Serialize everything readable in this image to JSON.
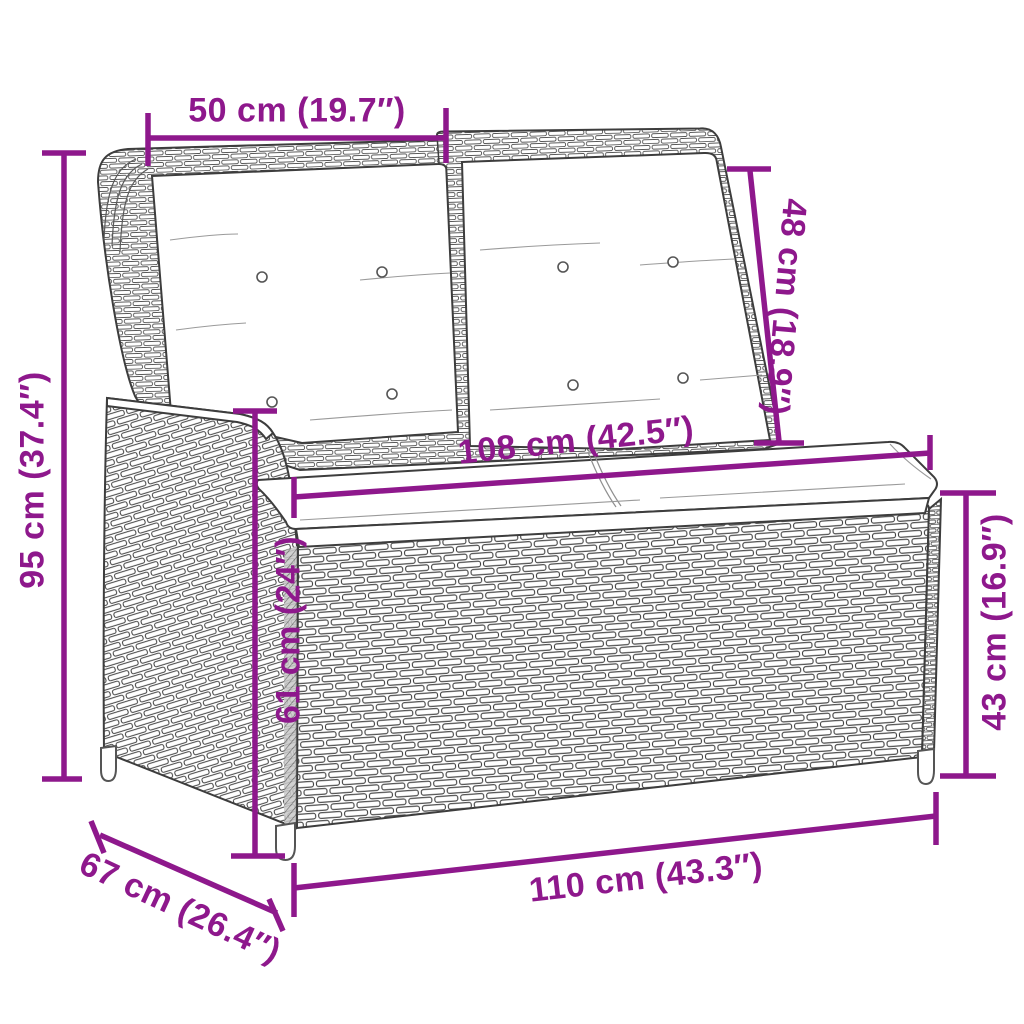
{
  "figure": {
    "type": "product-dimension-diagram",
    "subject": "poly rattan reclining garden bench with white cushions",
    "background": "#ffffff"
  },
  "colors": {
    "dimension_accent": "#8e188c",
    "line_art": "#3d3d3d",
    "cushion": "#ffffff"
  },
  "dimensions": {
    "backrest_width": {
      "cm": 50,
      "inch": "19.7",
      "label": "50 cm (19.7″)"
    },
    "backrest_height": {
      "cm": 48,
      "inch": "18.9",
      "label": "48 cm (18.9″)"
    },
    "total_height": {
      "cm": 95,
      "inch": "37.4",
      "label": "95 cm (37.4″)"
    },
    "seat_width": {
      "cm": 108,
      "inch": "42.5",
      "label": "108 cm (42.5″)"
    },
    "seat_front_height": {
      "cm": 61,
      "inch": "24",
      "label": "61 cm (24″)"
    },
    "side_height": {
      "cm": 43,
      "inch": "16.9",
      "label": "43 cm (16.9″)"
    },
    "depth": {
      "cm": 67,
      "inch": "26.4",
      "label": "67 cm (26.4″)"
    },
    "total_width": {
      "cm": 110,
      "inch": "43.3",
      "label": "110 cm (43.3″)"
    }
  }
}
